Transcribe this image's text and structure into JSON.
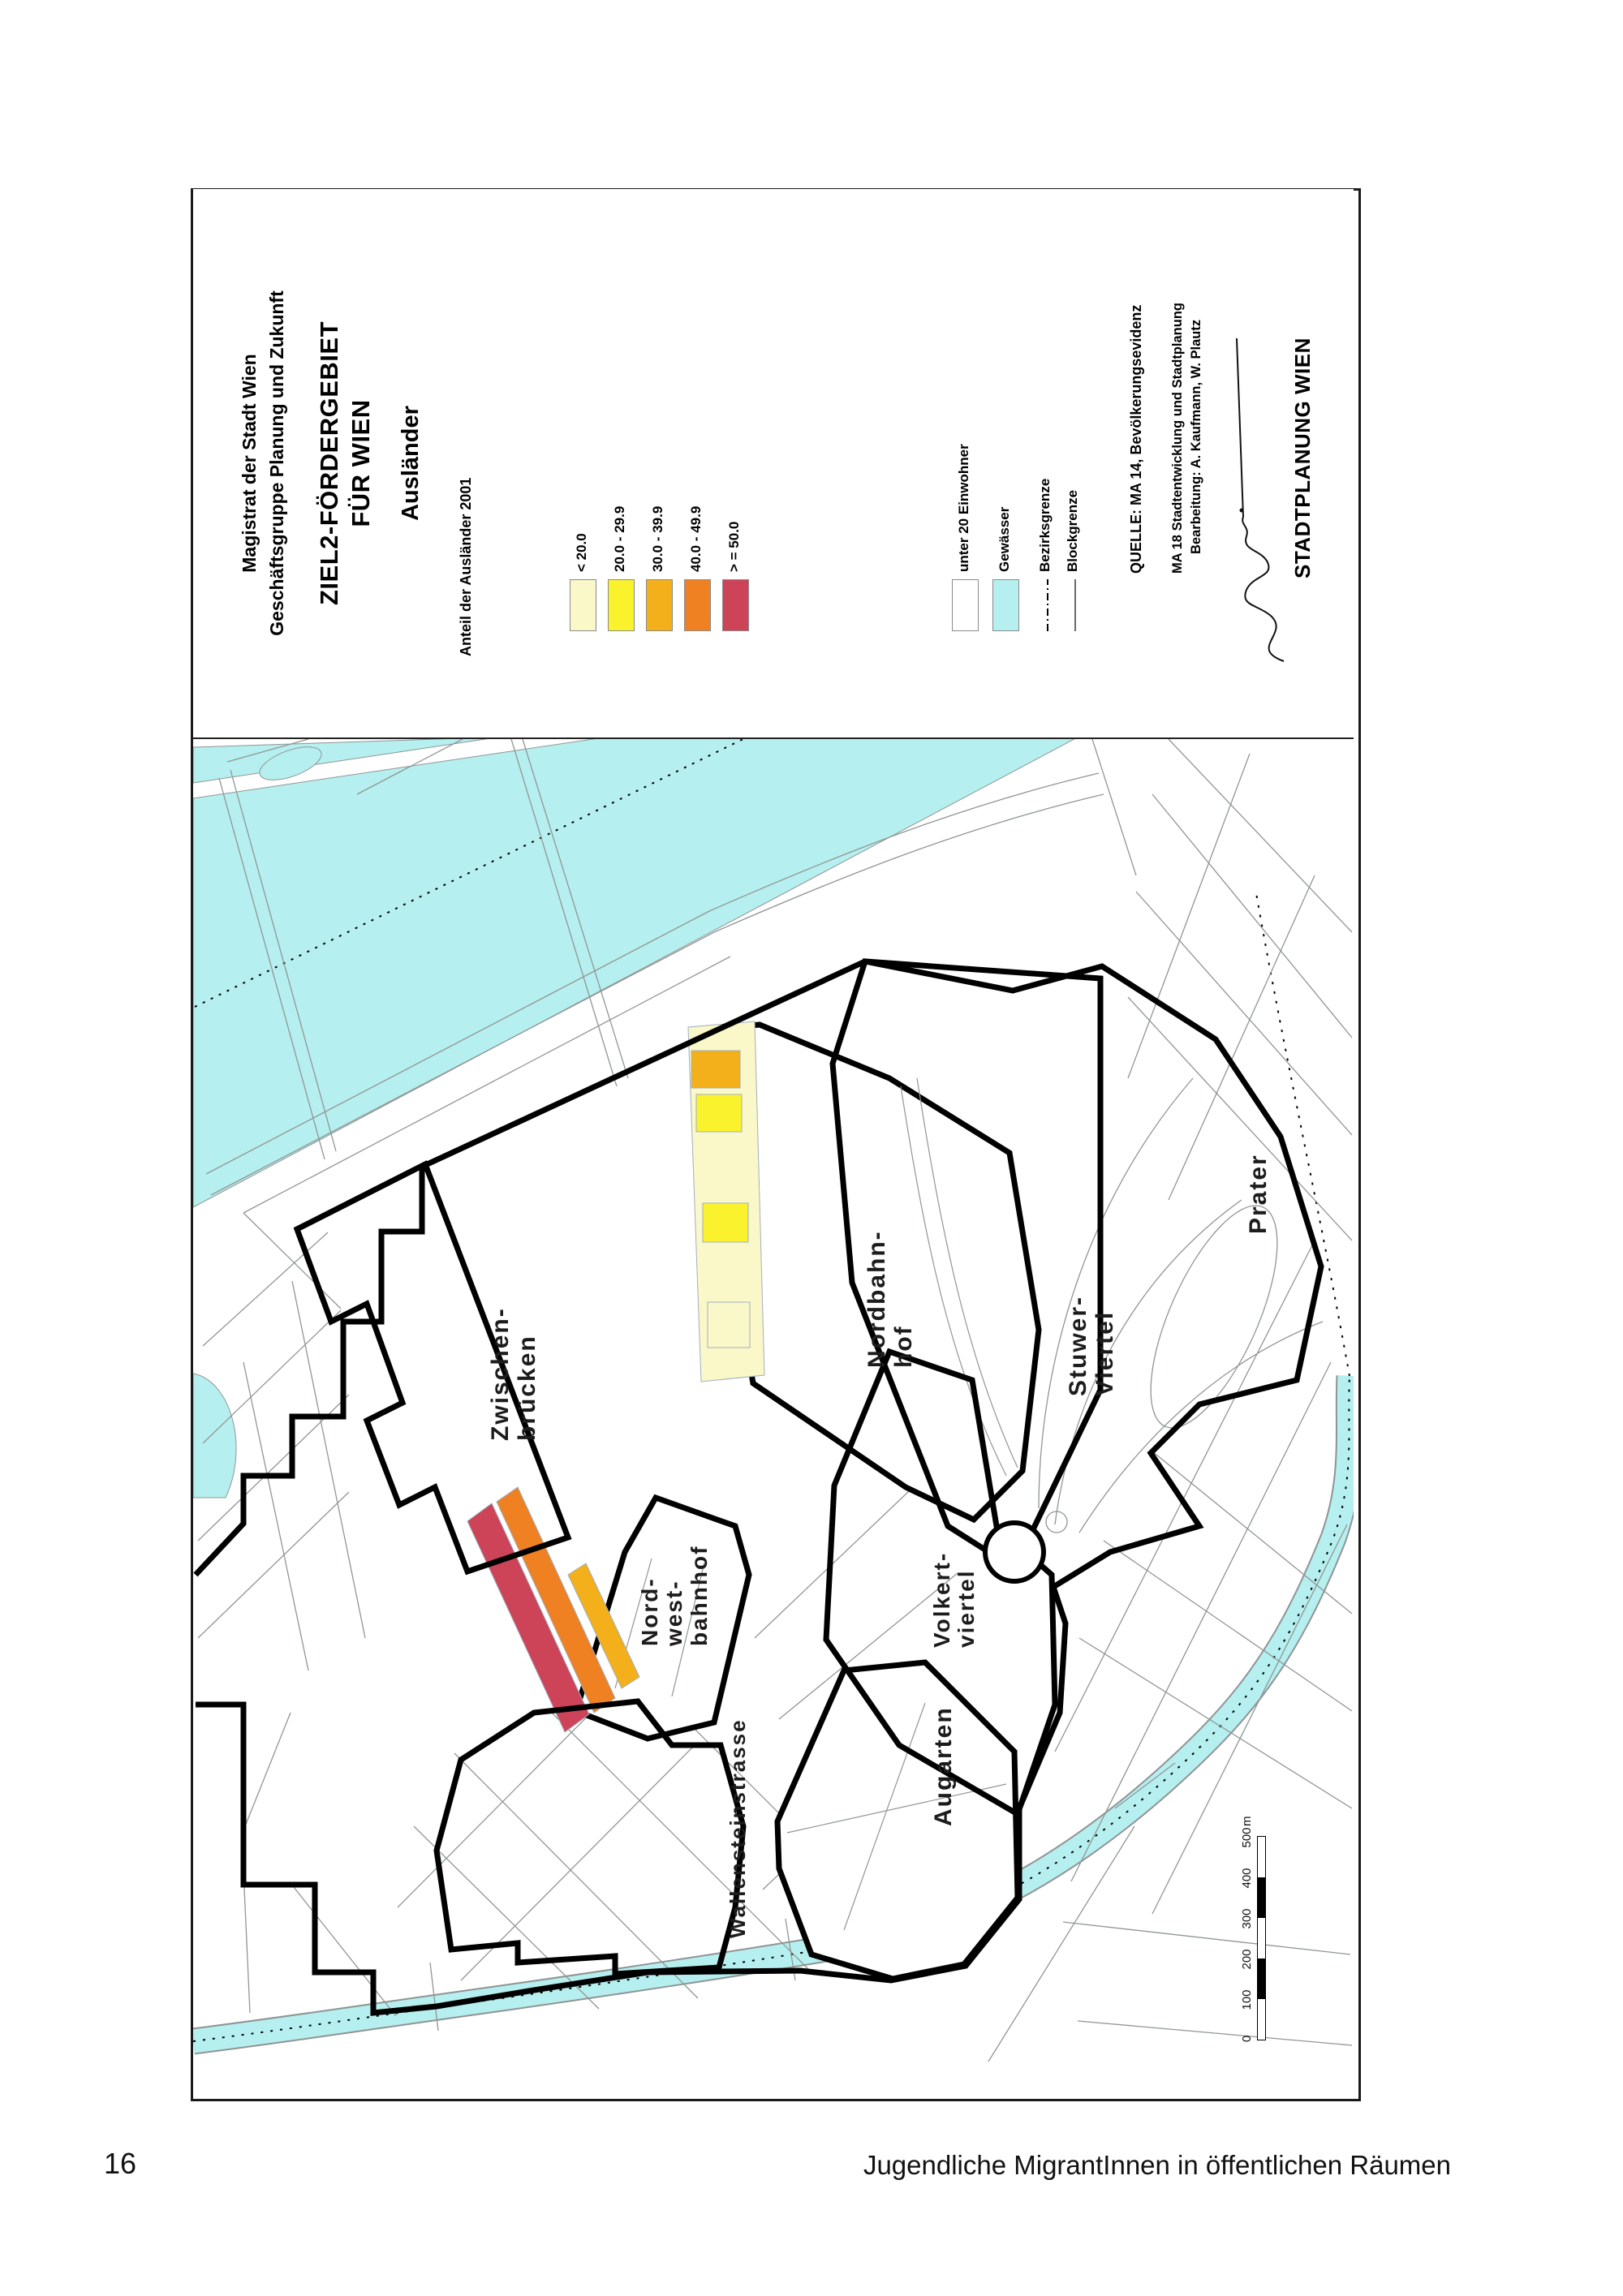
{
  "footer": {
    "page_number": "16",
    "title": "Jugendliche MigrantInnen in öffentlichen Räumen"
  },
  "legend": {
    "org_line1": "Magistrat der Stadt Wien",
    "org_line2": "Geschäftsgruppe Planung und Zukunft",
    "title_line1": "ZIEL2-FÖRDERGEBIET",
    "title_line2": "FÜR WIEN",
    "subtitle": "Ausländer",
    "scale_title": "Anteil der Ausländer 2001",
    "classes": [
      {
        "label": "< 20.0",
        "color": "#FAF7C9"
      },
      {
        "label": "20.0 - 29.9",
        "color": "#FBF22E"
      },
      {
        "label": "30.0 - 39.9",
        "color": "#F3B01A"
      },
      {
        "label": "40.0 - 49.9",
        "color": "#EF8122"
      },
      {
        "label": "> = 50.0",
        "color": "#CD4357"
      }
    ],
    "area_items": [
      {
        "label": "unter 20 Einwohner",
        "color": "#FFFFFF"
      },
      {
        "label": "Gewässer",
        "color": "#B6EFEF"
      }
    ],
    "line_items": [
      {
        "label": "Bezirksgrenze",
        "style": "dashdot"
      },
      {
        "label": "Blockgrenze",
        "style": "solid"
      }
    ],
    "source_line1": "QUELLE: MA 14, Bevölkerungsevidenz",
    "source_line2": "MA 18 Stadtentwicklung und Stadtplanung",
    "source_line3": "Bearbeitung: A. Kaufmann, W. Plautz",
    "agency": "STADTPLANUNG WIEN"
  },
  "map": {
    "labels": [
      {
        "id": "zwischenbruecken",
        "lines": [
          "Zwischen-",
          "brücken"
        ]
      },
      {
        "id": "nordwestbahnhof",
        "lines": [
          "Nord-",
          "west-",
          "bahnhof"
        ]
      },
      {
        "id": "wallensteinstrasse",
        "lines": [
          "Wallensteinstrasse"
        ]
      },
      {
        "id": "nordbahnhof",
        "lines": [
          "Nordbahn-",
          "hof"
        ]
      },
      {
        "id": "augarten",
        "lines": [
          "Augarten"
        ]
      },
      {
        "id": "volkertviertel",
        "lines": [
          "Volkert-",
          "viertel"
        ]
      },
      {
        "id": "stuwerviertel",
        "lines": [
          "Stuwer-",
          "Viertel"
        ]
      },
      {
        "id": "prater",
        "lines": [
          "Prater"
        ]
      }
    ],
    "scalebar": {
      "ticks": [
        "0",
        "100",
        "200",
        "300",
        "400",
        "500"
      ],
      "unit": "m"
    }
  },
  "colors": {
    "water": "#B6EFEF",
    "street": "#909695",
    "boundary": "#000000",
    "block_outline": "#9FB0C0"
  }
}
